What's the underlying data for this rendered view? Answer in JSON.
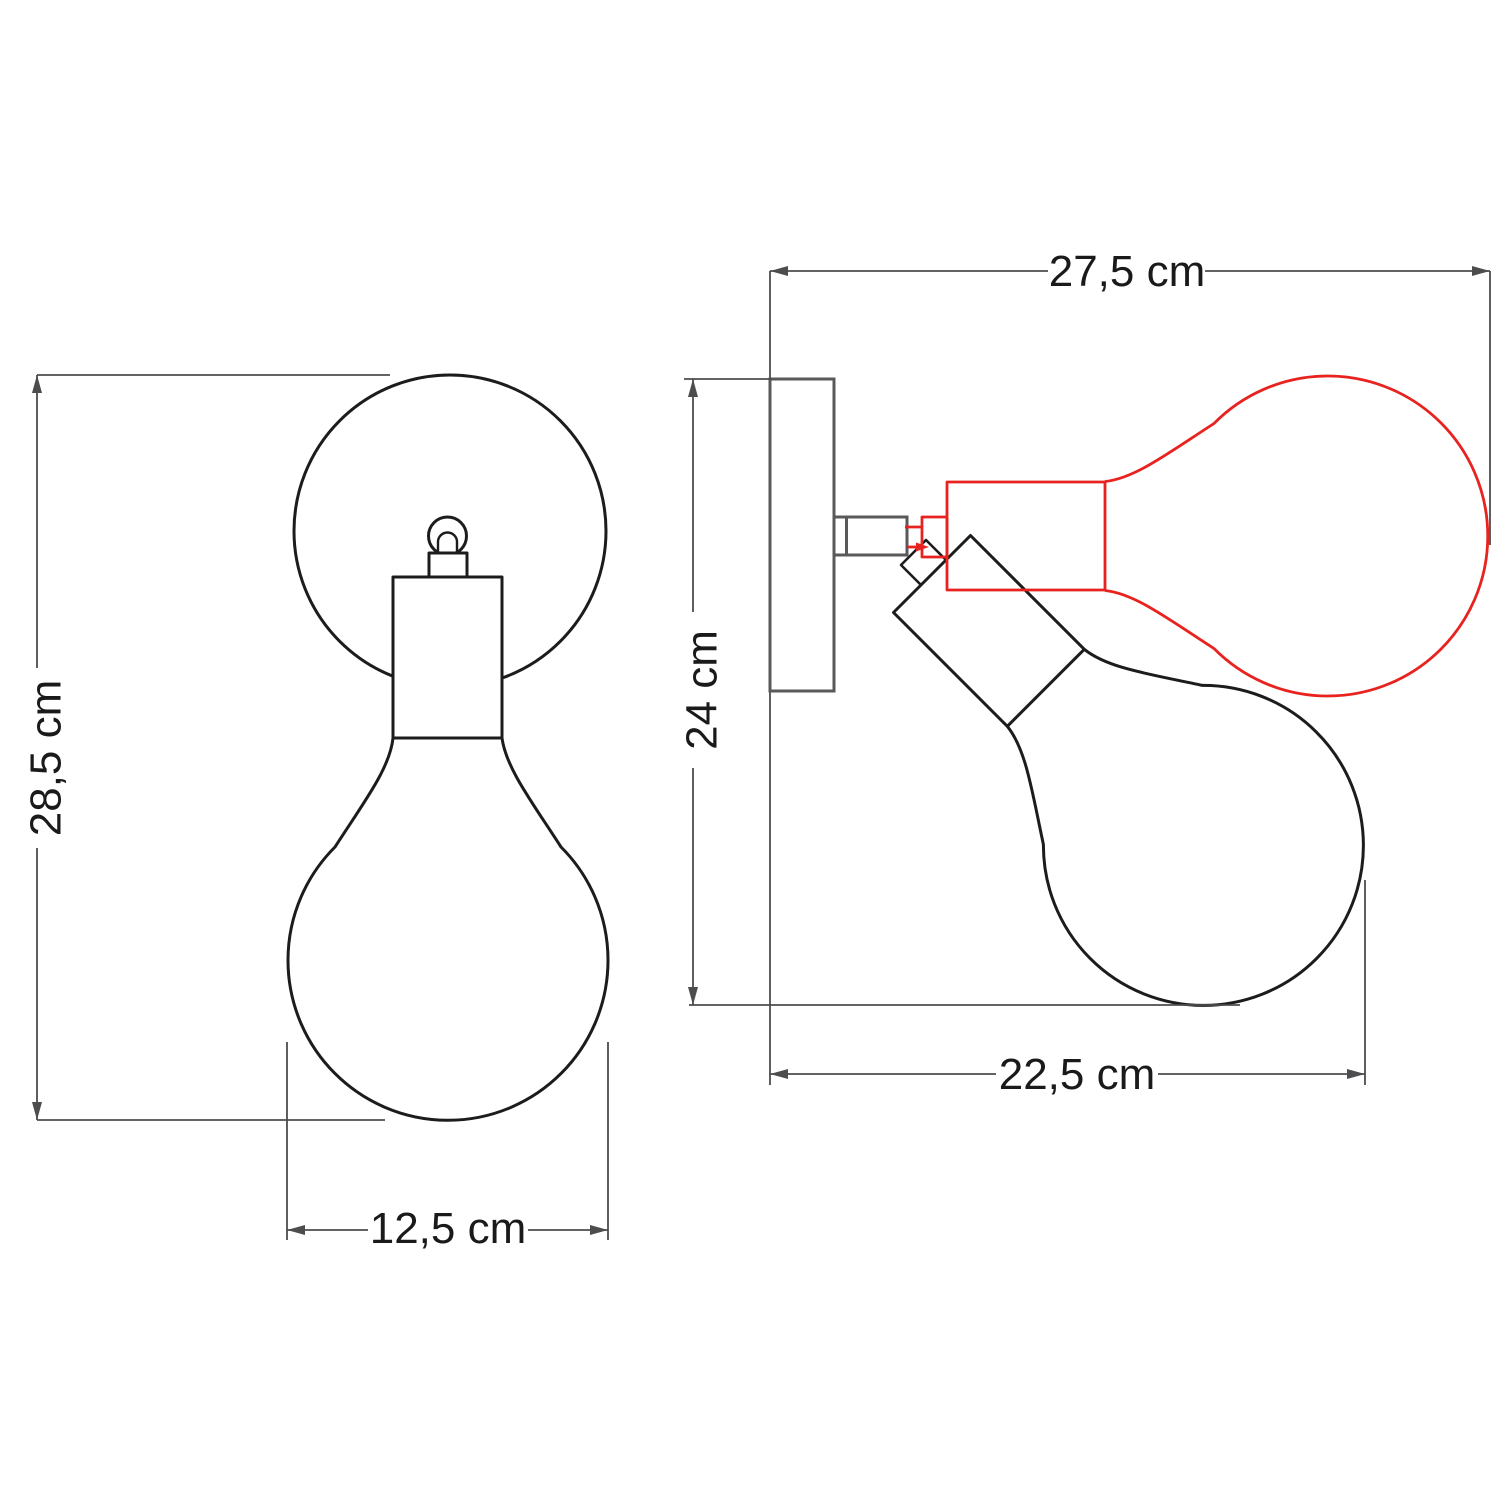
{
  "diagram": {
    "background": "#ffffff",
    "colors": {
      "outline": "#1c1c1c",
      "dimension_lines": "#4d4d4f",
      "side_fixture": "#59595b",
      "alternate_position": "#e8231f",
      "label_text": "#1a1a1a"
    },
    "front_view": {
      "description": "wall lamp front view with globe bulb",
      "dimensions": {
        "height": "28,5 cm",
        "width": "12,5 cm"
      }
    },
    "side_view": {
      "description": "wall lamp side view, black bulb tilted down, red alternate position tilted up",
      "dimensions": {
        "reach": "27,5 cm",
        "height": "24 cm",
        "depth": "22,5 cm"
      }
    }
  }
}
